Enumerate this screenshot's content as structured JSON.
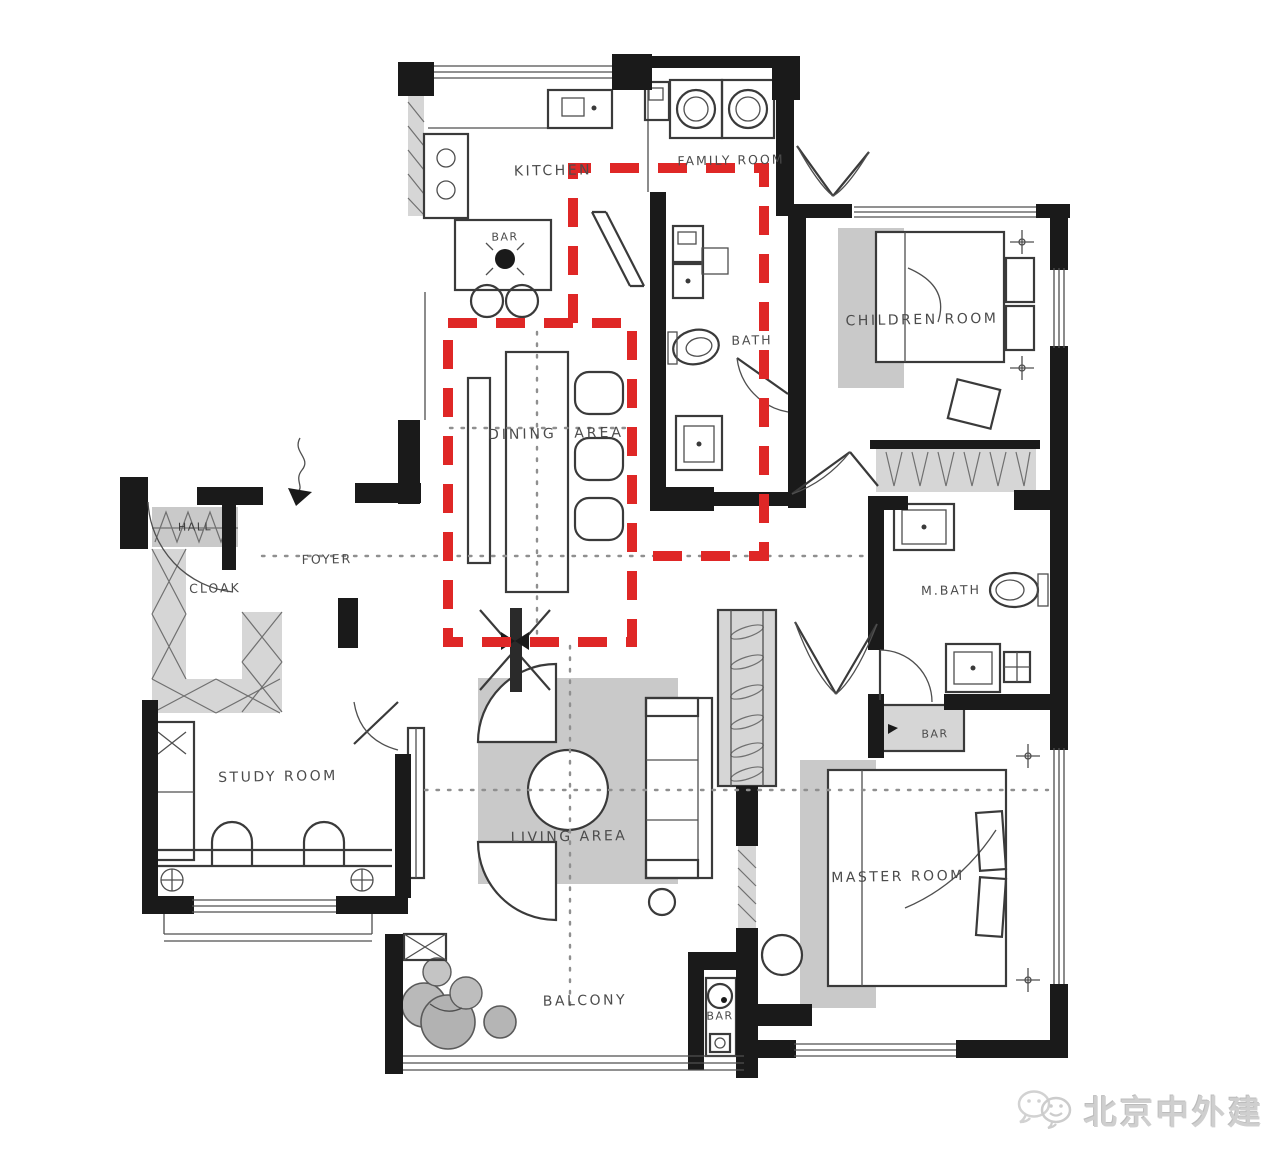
{
  "rooms": {
    "kitchen": {
      "label": "KITCHEN"
    },
    "family_room": {
      "label": "FAMILY ROOM"
    },
    "bar_kitchen": {
      "label": "BAR"
    },
    "bath": {
      "label": "BATH"
    },
    "children_room": {
      "label": "CHILDREN ROOM"
    },
    "dining_area": {
      "label": "DINING AREA"
    },
    "foyer": {
      "label": "FOYER"
    },
    "hall": {
      "label": "HALL"
    },
    "cloak": {
      "label": "CLOAK"
    },
    "m_bath": {
      "label": "M.BATH"
    },
    "bar_mbath": {
      "label": "BAR"
    },
    "study_room": {
      "label": "STUDY ROOM"
    },
    "living_area": {
      "label": "LIVING AREA"
    },
    "master_room": {
      "label": "MASTER ROOM"
    },
    "balcony": {
      "label": "BALCONY"
    },
    "bar_balcony": {
      "label": "BAR"
    }
  },
  "watermark": {
    "text": "北京中外建",
    "icon": "wechat-icon"
  },
  "colors": {
    "highlight_red": "#df2726",
    "wall_black": "#1a1a1a",
    "furniture_gray": "#c9c9c9",
    "label_gray": "#4c4c4c",
    "watermark_gray": "#cfcfcf"
  }
}
